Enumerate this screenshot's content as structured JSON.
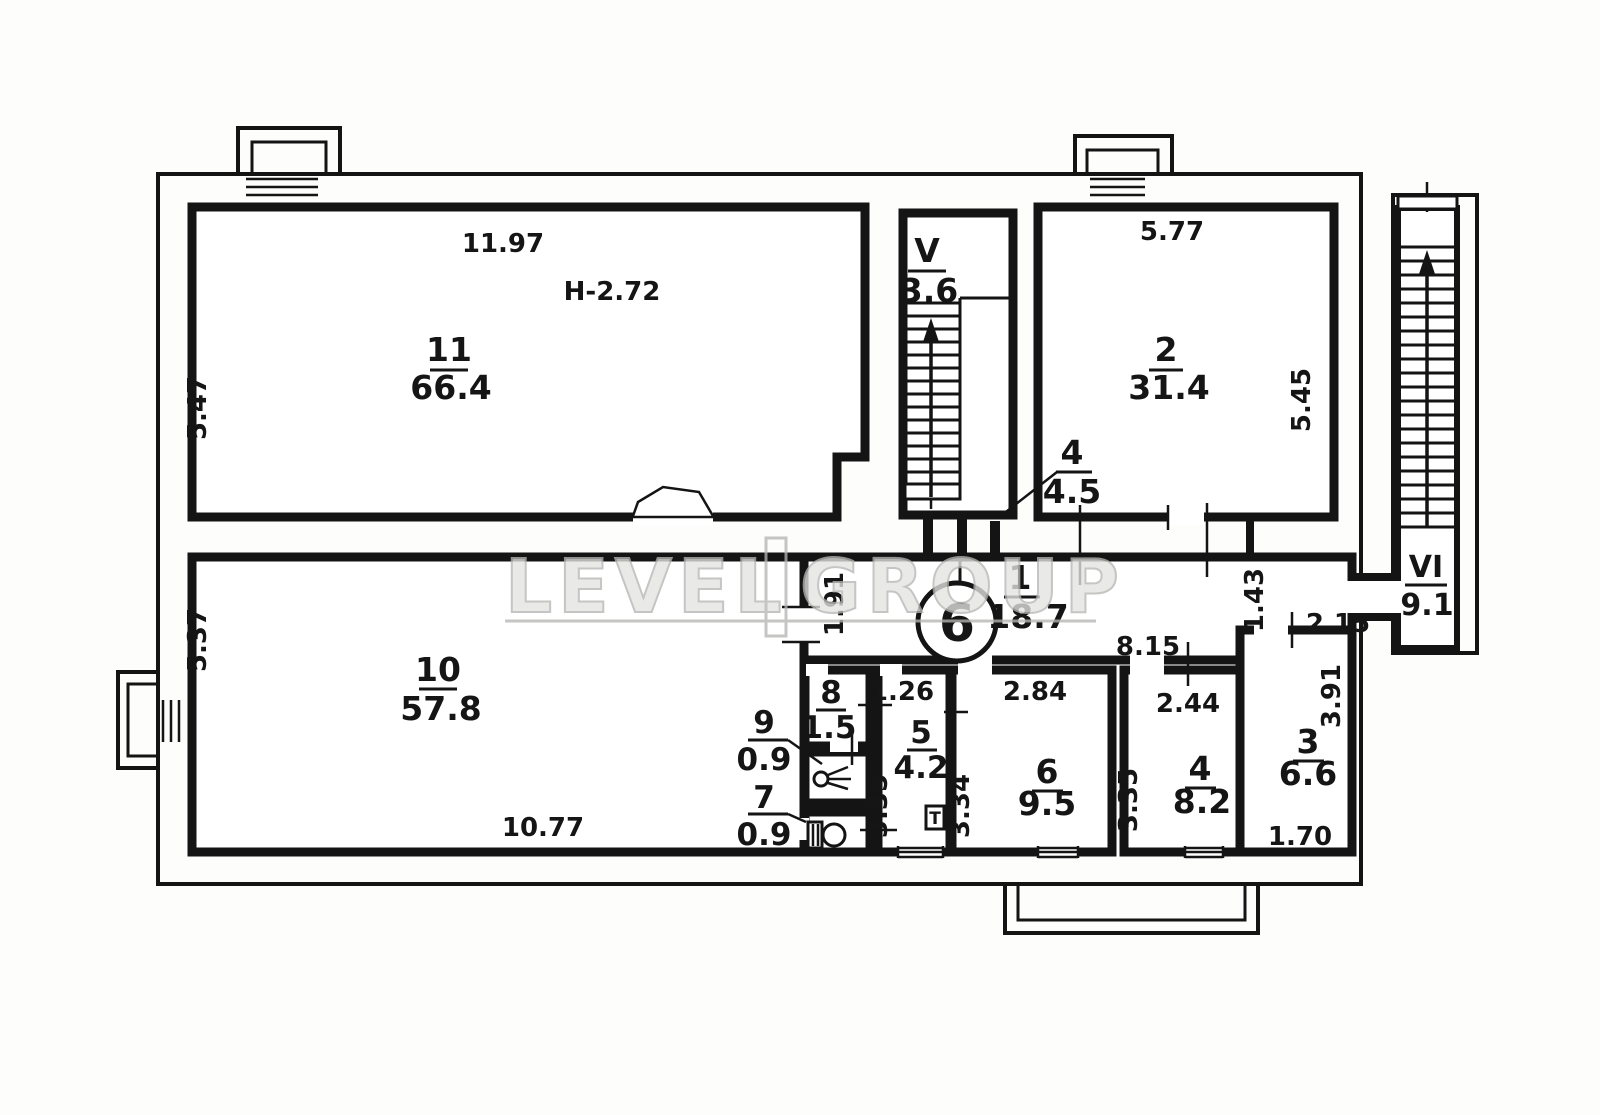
{
  "plan": {
    "watermark": {
      "left": "LEVEL",
      "right": "GROUP"
    },
    "rooms": {
      "r11": {
        "num": "11",
        "area": "66.4"
      },
      "r2": {
        "num": "2",
        "area": "31.4"
      },
      "rV": {
        "num": "V",
        "area": "3.6"
      },
      "r4u": {
        "num": "4",
        "area": "4.5"
      },
      "r1": {
        "num": "1",
        "area": "18.7"
      },
      "rVI": {
        "num": "VI",
        "area": "9.1"
      },
      "r10": {
        "num": "10",
        "area": "57.8"
      },
      "r8": {
        "num": "8",
        "area": "1.5"
      },
      "r9": {
        "num": "9",
        "area": "0.9"
      },
      "r7": {
        "num": "7",
        "area": "0.9"
      },
      "r5": {
        "num": "5",
        "area": "4.2"
      },
      "r6": {
        "num": "6",
        "area": "9.5"
      },
      "r4": {
        "num": "4",
        "area": "8.2"
      },
      "r3": {
        "num": "3",
        "area": "6.6"
      }
    },
    "dims": {
      "r11_top": "11.97",
      "r11_left": "5.47",
      "ceiling_height": "H-2.72",
      "r2_top": "5.77",
      "r2_right": "5.45",
      "r10_left": "5.37",
      "r10_bottom": "10.77",
      "r1_left": "1.91",
      "r1_bottom": "8.15",
      "r1_right": "1.43",
      "r1_end": "2.15",
      "r5_top": "1.26",
      "r5_left": "3.35",
      "r6_top": "2.84",
      "r6_left": "3.34",
      "r4_top": "2.44",
      "r4_left": "3.35",
      "r3_right": "3.91",
      "r3_bottom": "1.70"
    },
    "shaft": {
      "label": "6"
    },
    "panel": {
      "label": "Т"
    }
  }
}
